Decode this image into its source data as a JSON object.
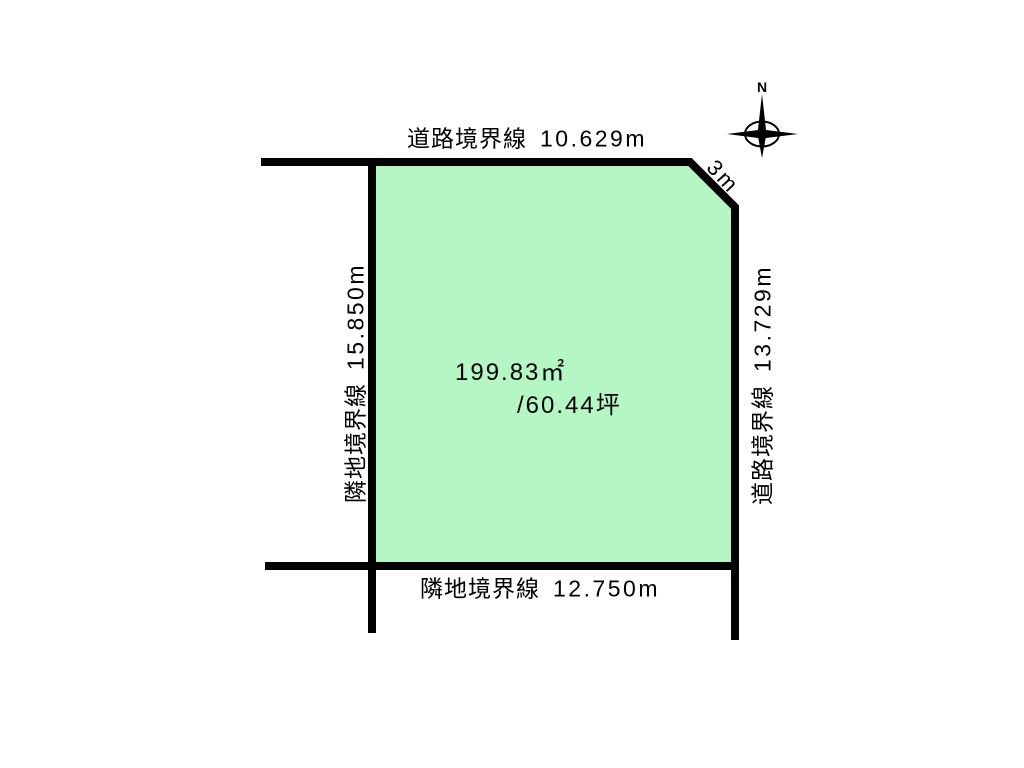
{
  "diagram": {
    "title": "land-plot-boundary-diagram",
    "area": {
      "square_meters": "199.83㎡",
      "tsubo": "/60.44坪"
    },
    "boundaries": {
      "top": {
        "label": "道路境界線",
        "value": "10.629m"
      },
      "right": {
        "label": "道路境界線",
        "value": "13.729m"
      },
      "bottom": {
        "label": "隣地境界線",
        "value": "12.750m"
      },
      "left": {
        "label": "隣地境界線",
        "value": "15.850m"
      },
      "corner_cut": {
        "value": "3m"
      }
    },
    "compass": {
      "north_label": "N"
    },
    "colors": {
      "plot_fill": "#b4f7c5",
      "boundary_line": "#000000",
      "background": "#ffffff",
      "text": "#000000"
    }
  }
}
